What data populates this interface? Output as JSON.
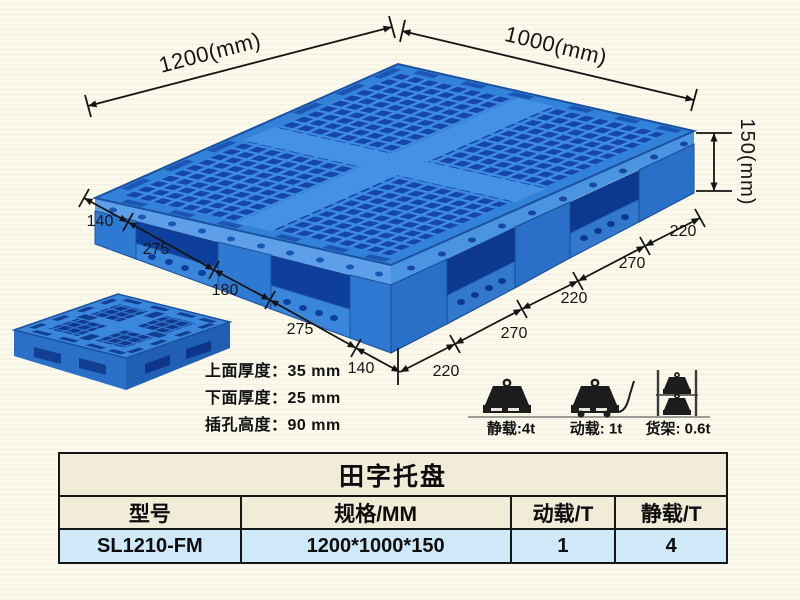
{
  "page": {
    "background_color": "#fbf9ec"
  },
  "diagram": {
    "dimensions": {
      "top_left_edge": "1200(mm)",
      "top_right_edge": "1000(mm)",
      "height": "150(mm)",
      "left_chain": [
        "140",
        "275",
        "180",
        "275",
        "140"
      ],
      "right_chain": [
        "220",
        "270",
        "220",
        "270",
        "220"
      ]
    },
    "notes": [
      "上面厚度：35 mm",
      "下面厚度：25 mm",
      "插孔高度：90 mm"
    ],
    "load_ratings": [
      {
        "icon": "static-load-icon",
        "label": "静载:4t"
      },
      {
        "icon": "dynamic-load-icon",
        "label": "动载: 1t"
      },
      {
        "icon": "rack-load-icon",
        "label": "货架: 0.6t"
      }
    ],
    "colors": {
      "pallet_blue": "#3282da",
      "pallet_hole_blue": "#1645ac",
      "dim_line": "#141414"
    }
  },
  "table": {
    "title": "田字托盘",
    "headers": [
      "型号",
      "规格/MM",
      "动载/T",
      "静载/T"
    ],
    "rows": [
      [
        "SL1210-FM",
        "1200*1000*150",
        "1",
        "4"
      ]
    ]
  }
}
